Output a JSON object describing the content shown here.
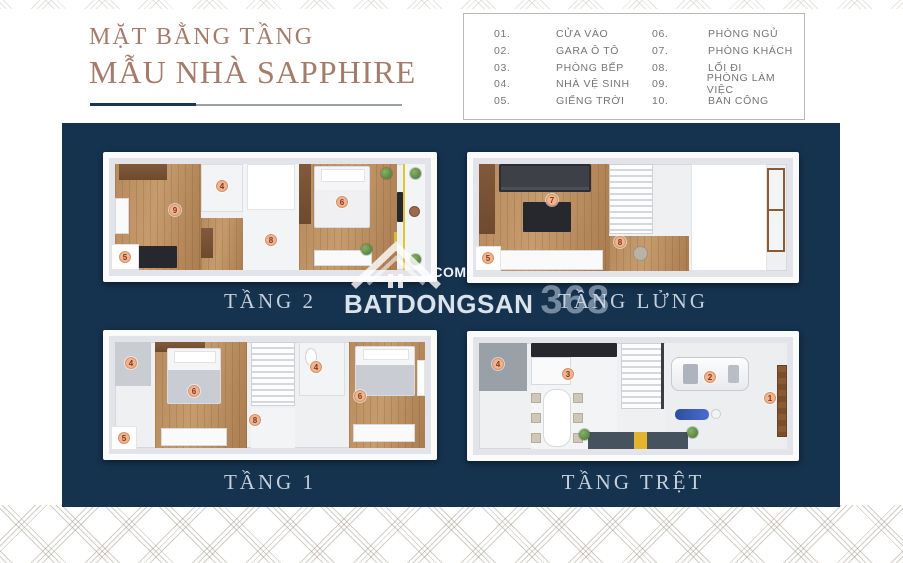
{
  "title": {
    "line1": "MẶT BẰNG TẦNG",
    "line2": "MẪU NHÀ SAPPHIRE"
  },
  "legend": {
    "items": [
      {
        "num": "01.",
        "label": "CỬA VÀO"
      },
      {
        "num": "02.",
        "label": "GARA Ô TÔ"
      },
      {
        "num": "03.",
        "label": "PHÒNG BẾP"
      },
      {
        "num": "04.",
        "label": "NHÀ VỆ SINH"
      },
      {
        "num": "05.",
        "label": "GIẾNG TRỜI"
      },
      {
        "num": "06.",
        "label": "PHÒNG NGỦ"
      },
      {
        "num": "07.",
        "label": "PHÒNG KHÁCH"
      },
      {
        "num": "08.",
        "label": "LỐI ĐI"
      },
      {
        "num": "09.",
        "label": "PHÒNG LÀM VIỆC"
      },
      {
        "num": "10.",
        "label": "BAN CÔNG"
      }
    ]
  },
  "plans": [
    {
      "label": "TẦNG 2",
      "markers": [
        "4",
        "9",
        "5",
        "8",
        "6"
      ]
    },
    {
      "label": "TẦNG LỬNG",
      "markers": [
        "7",
        "5",
        "8"
      ]
    },
    {
      "label": "TẦNG 1",
      "markers": [
        "4",
        "6",
        "5",
        "8",
        "4",
        "6"
      ]
    },
    {
      "label": "TẦNG TRỆT",
      "markers": [
        "4",
        "3",
        "2",
        "1"
      ]
    }
  ],
  "watermark": {
    "brand": "BATDONGSAN",
    "number": "368",
    "domain": ".COM"
  },
  "colors": {
    "navy": "#15324f",
    "title_brown": "#a57c6c",
    "marker_bg": "#f2b48e",
    "marker_text": "#7d3a22"
  }
}
